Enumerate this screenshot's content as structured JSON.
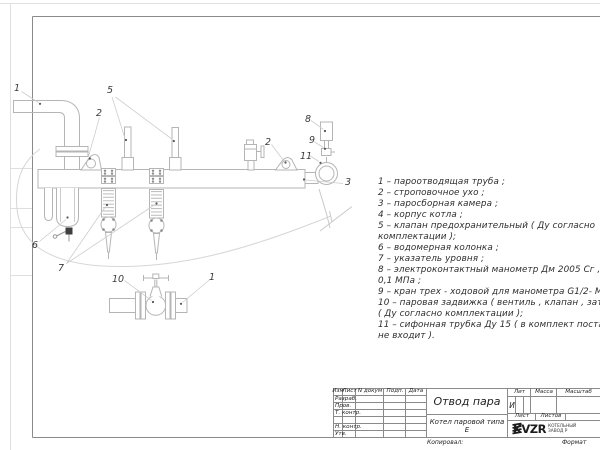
{
  "sheet": {
    "callouts": {
      "outlet_pipe": "1",
      "lifting_lug_left": "2",
      "steam_chamber": "3",
      "safety_valves": "5",
      "water_column": "6",
      "level_gauges": "7",
      "manometer": "8",
      "three_way_cock": "9",
      "gate_valve": "10",
      "outlet_pipe_bottom": "1",
      "lifting_lug_right": "2",
      "siphon_tube": "11"
    },
    "parts_list_lines": [
      "1 –  пароотводящая труба ;",
      "2 –  строповочное ухо ;",
      "3 –  паросборная камера ;",
      "4 –  корпус котла ;",
      "5 –  клапан предохранительный  ( Ду согласно",
      "комплектации );",
      "6 –  водомерная колонка ;",
      "7 – указатель уровня ;",
      "8 – электроконтактный манометр  Дм 2005 Сг ,  Ру",
      "0,1  МПа ;",
      "9 –  кран трех - ходовой для манометра  G1/2- М 20;",
      "10 –  паровая задвижка  ( вентиль ,  клапан ,  затвор",
      "( Ду согласно комплектации );",
      "11 –  сифонная трубка  Ду 15 ( в комплект поставки",
      "не входит )."
    ]
  },
  "title_block": {
    "change_header": {
      "izm": "Изм",
      "list": "Лист",
      "doc": "N докум",
      "sign": "Подп.",
      "date": "Дата"
    },
    "signature_rows": [
      "Разраб.",
      "Пров.",
      "Т. контр.",
      "Н. контр.",
      "Утв."
    ],
    "doc_title": "Отвод пара",
    "product": "Котел паровой типа Е",
    "lit_label": "Лит",
    "lit_value": "И",
    "mass_label": "Масса",
    "scale_label": "Масштаб",
    "sheet_label": "Лист",
    "sheets_label": "Листов",
    "company": {
      "logo": "KVZR",
      "caption1": "КОТЕЛЬНЫЙ",
      "caption2": "ЗАВОД Р"
    },
    "footer": {
      "copied": "Копировал:",
      "format": "Формат"
    }
  },
  "colors": {
    "equipment_line": "#b5b5b5",
    "faint_line": "#d6d6d6",
    "frame_line": "#8a8a8a",
    "text": "#2e2e2e",
    "dot": "#555555"
  }
}
